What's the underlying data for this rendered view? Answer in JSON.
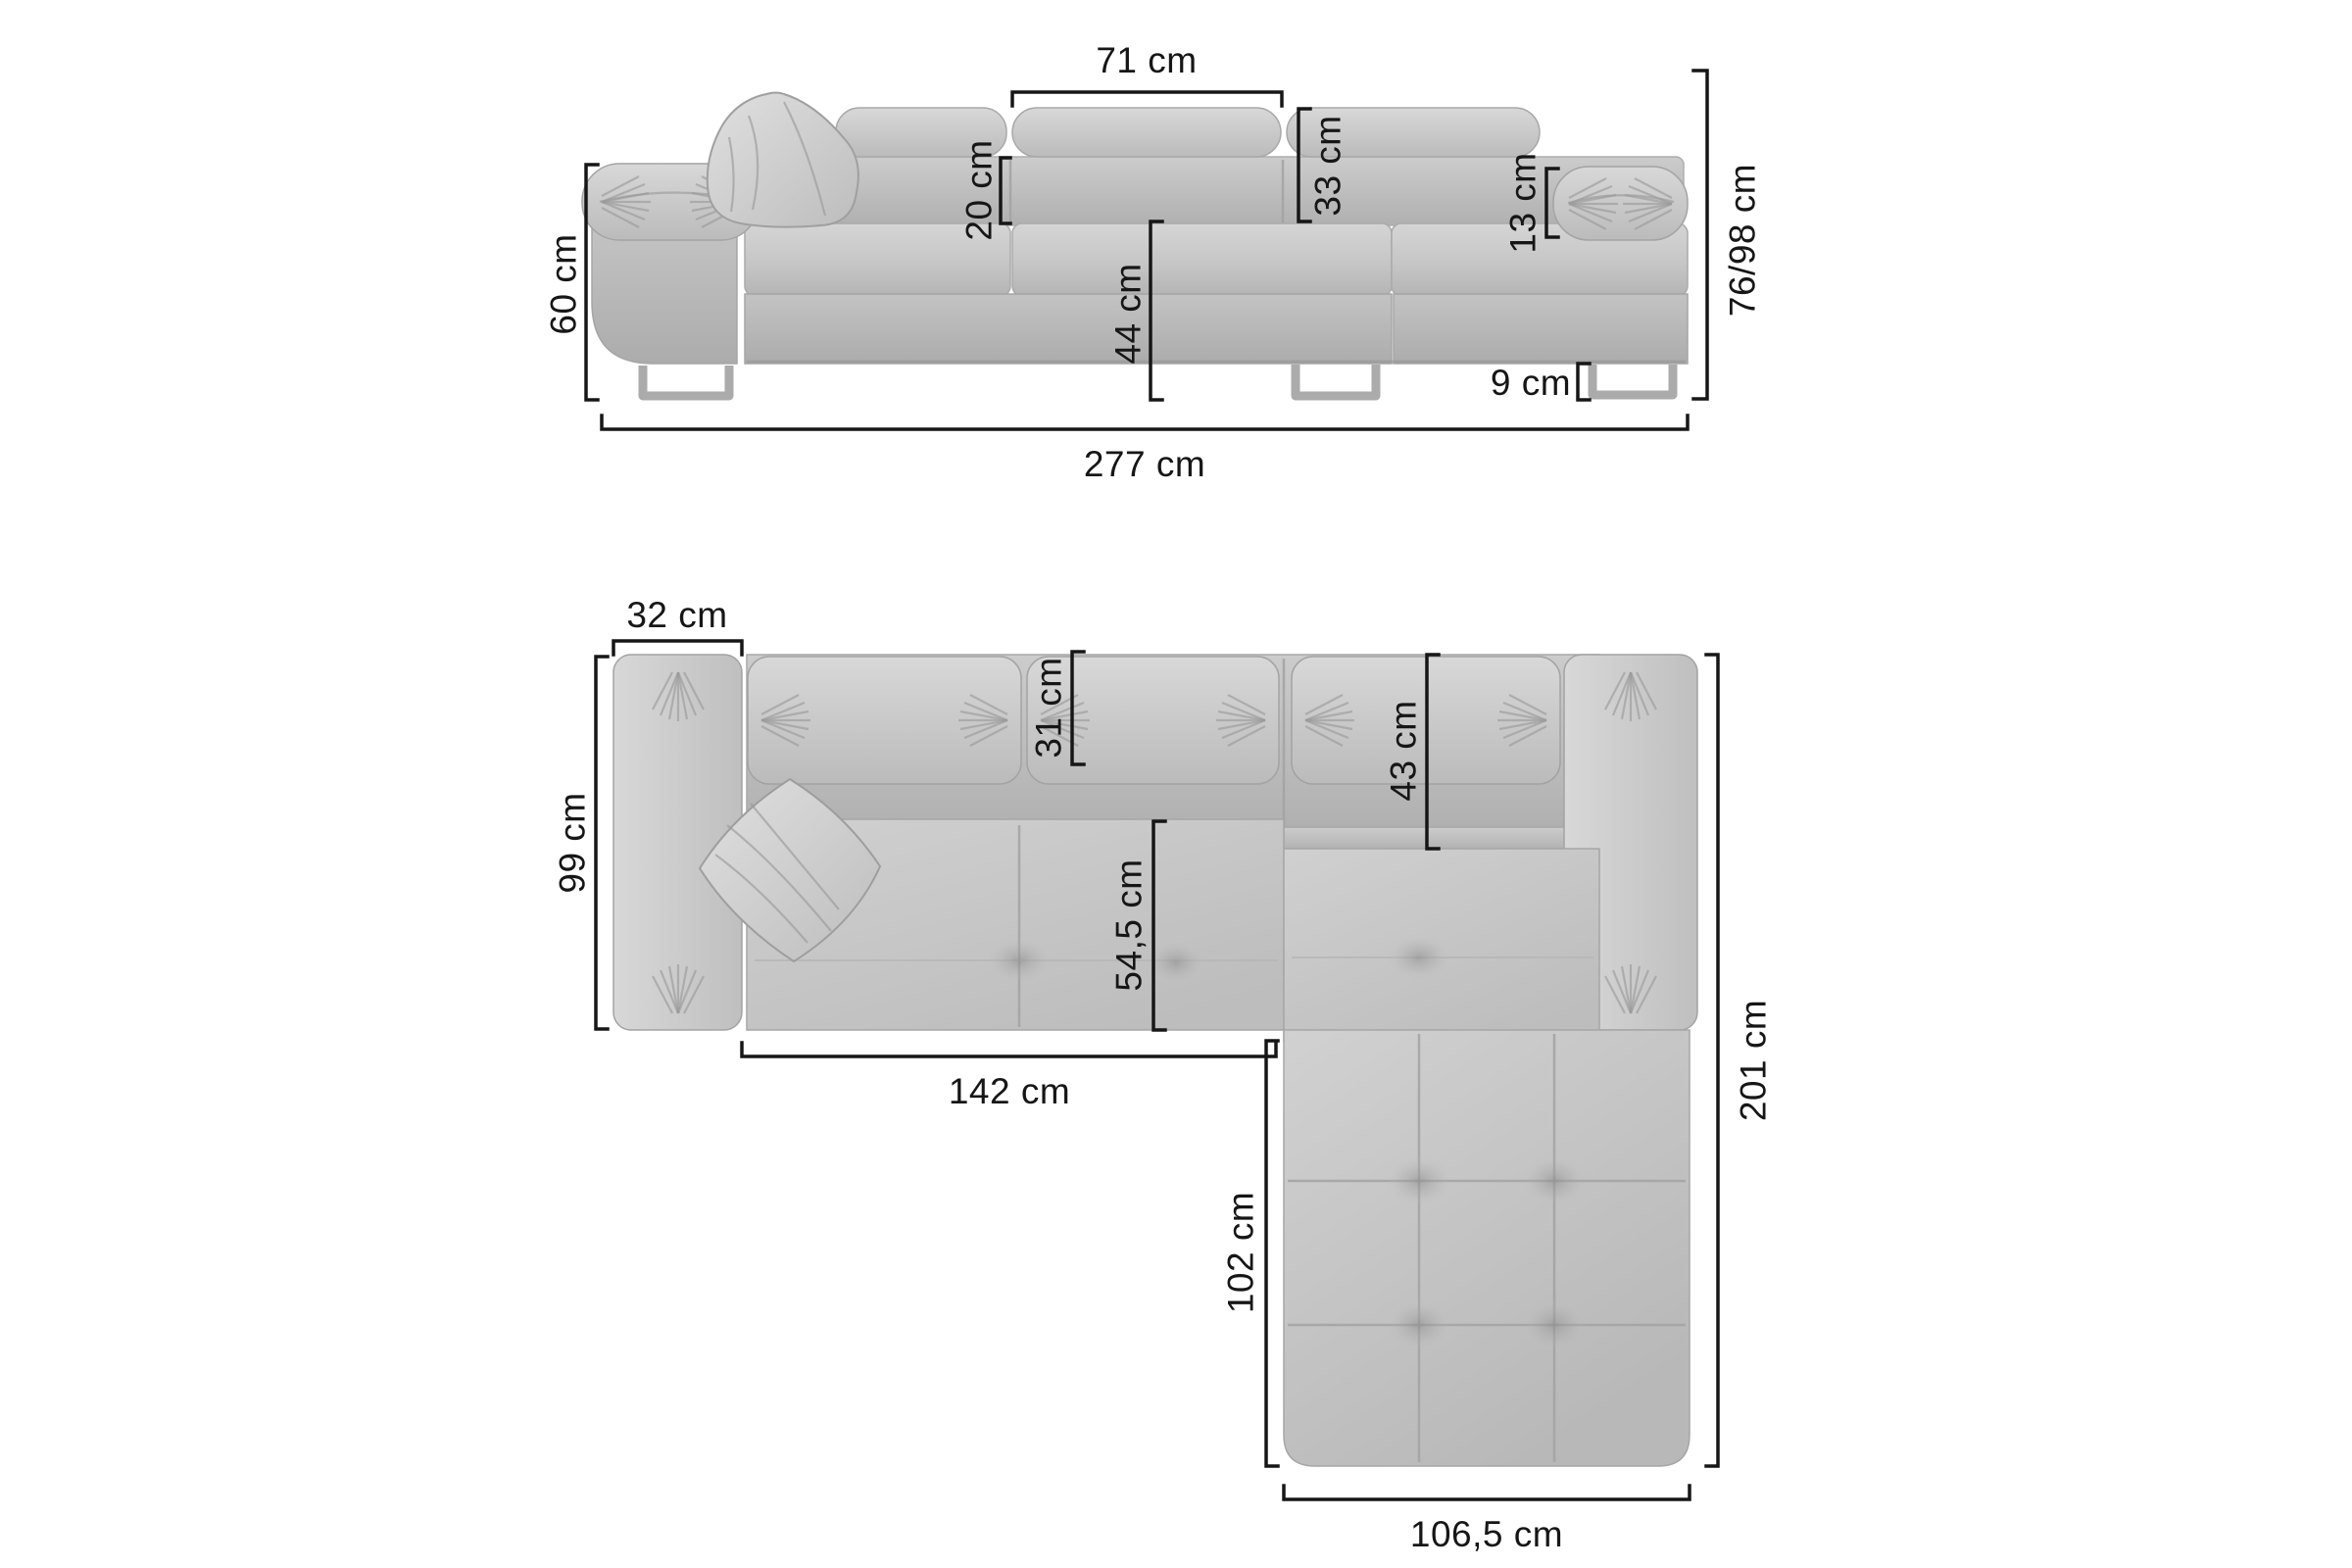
{
  "diagram": {
    "subject": "corner-sofa-dimension-diagram",
    "unit": "cm",
    "views": {
      "front": "front elevation",
      "top": "top view"
    }
  },
  "front_view": {
    "labels": {
      "headrest_width": "71 cm",
      "back_gap_height": "20 cm",
      "headrest_span": "33 cm",
      "armrest_pad_height": "13 cm",
      "armrest_height": "60 cm",
      "seat_height": "44 cm",
      "leg_height": "9 cm",
      "total_height": "76/98 cm",
      "total_width": "277 cm"
    }
  },
  "top_view": {
    "labels": {
      "armrest_width": "32 cm",
      "side_depth": "99 cm",
      "back_cushion_depth": "31 cm",
      "corner_back_depth": "43 cm",
      "seat_depth": "54,5 cm",
      "seat_width": "142 cm",
      "chaise_length": "102 cm",
      "chaise_width": "106,5 cm",
      "total_depth": "201 cm"
    }
  },
  "colors": {
    "background": "#ffffff",
    "dimension_lines": "#161616",
    "label_text": "#161616",
    "sofa_light": "#d6d6d6",
    "sofa_mid": "#c6c6c6",
    "sofa_dark": "#b2b2b2",
    "seam": "#a2a2a2",
    "leg_metal": "#ababab"
  }
}
